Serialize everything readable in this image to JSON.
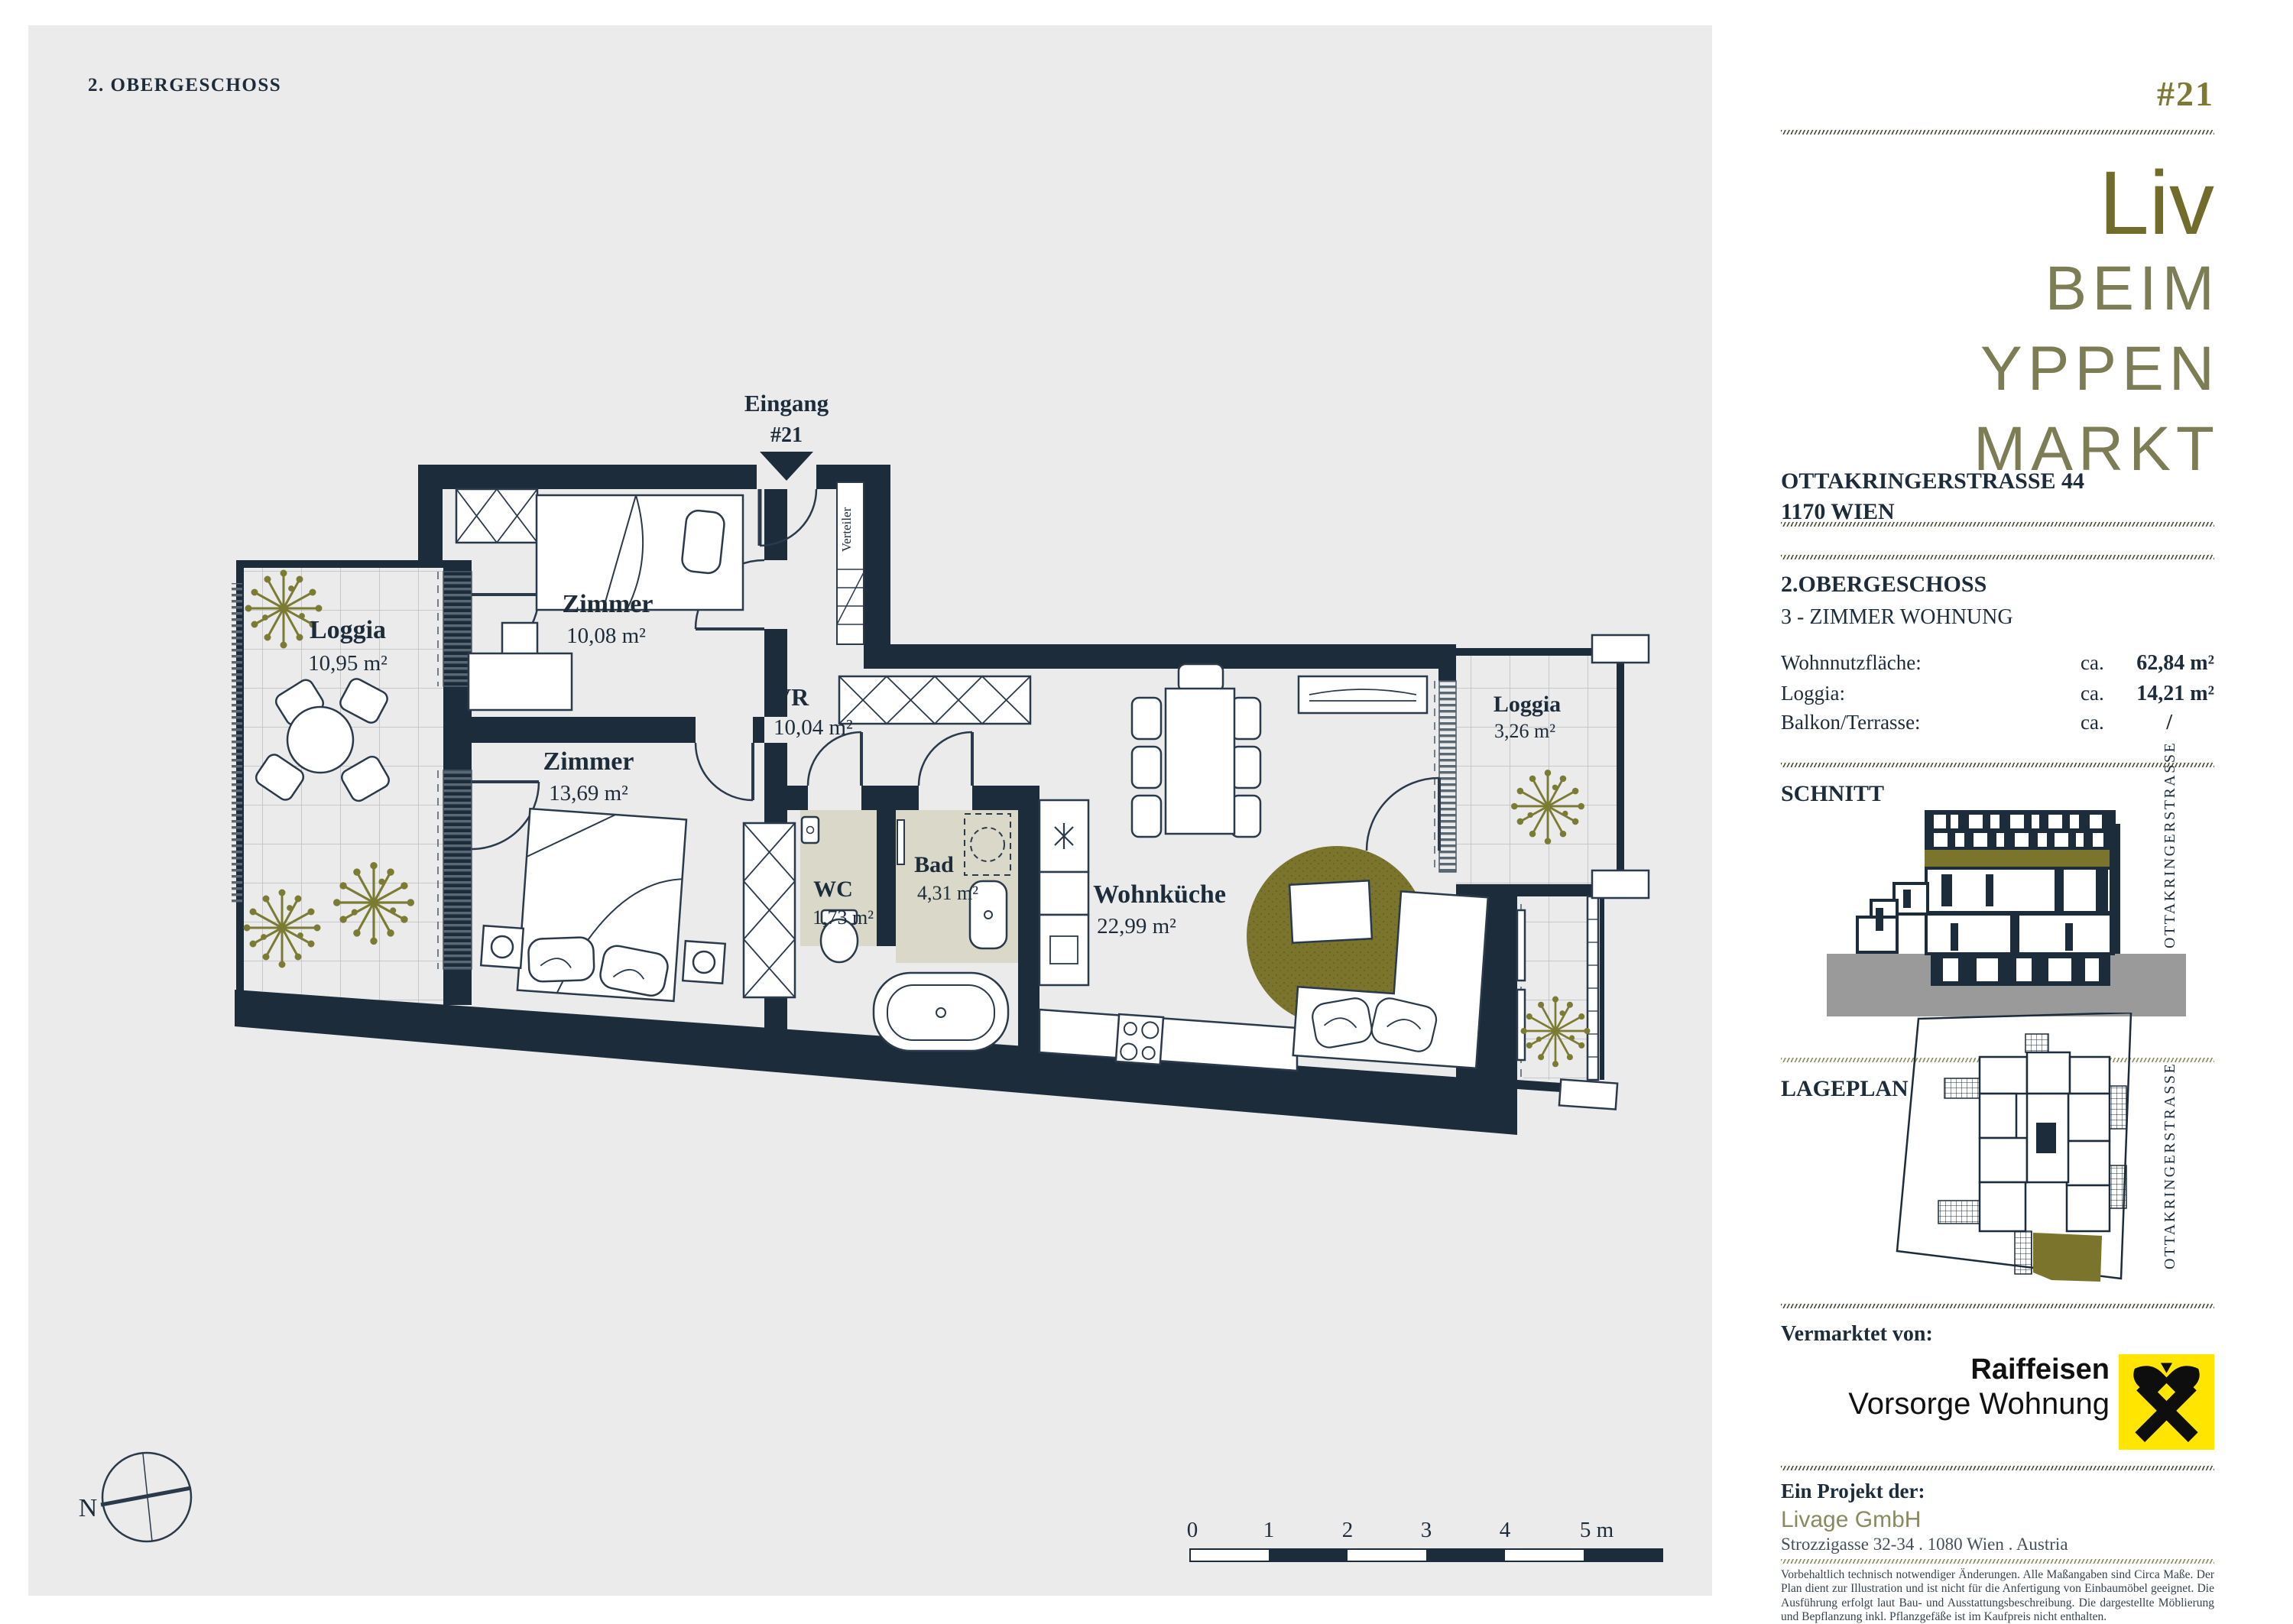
{
  "page": {
    "floor_label": "2. OBERGESCHOSS"
  },
  "plan": {
    "entrance": {
      "label": "Eingang",
      "unit": "#21"
    },
    "verteiler": "Verteiler",
    "compass": "N",
    "scale_labels": [
      "0",
      "1",
      "2",
      "3",
      "4",
      "5 m"
    ],
    "rooms": [
      {
        "name": "Loggia",
        "area": "10,95 m²"
      },
      {
        "name": "Zimmer",
        "area": "10,08 m²"
      },
      {
        "name": "Zimmer",
        "area": "13,69 m²"
      },
      {
        "name": "VR",
        "area": "10,04 m²"
      },
      {
        "name": "WC",
        "area": "1,73 m²"
      },
      {
        "name": "Bad",
        "area": "4,31 m²"
      },
      {
        "name": "Wohnküche",
        "area": "22,99 m²"
      },
      {
        "name": "Loggia",
        "area": "3,26 m²"
      }
    ]
  },
  "sidebar": {
    "unit_number": "#21",
    "logo_lines": [
      "Liv",
      "BEIM",
      "YPPEN",
      "MARKT"
    ],
    "address_line1": "OTTAKRINGERSTRASSE 44",
    "address_line2": "1170 WIEN",
    "floor_title": "2.OBERGESCHOSS",
    "floor_subtitle": "3 - ZIMMER WOHNUNG",
    "metrics": [
      {
        "label": "Wohnnutzfläche:",
        "approx": "ca.",
        "value": "62,84 m²"
      },
      {
        "label": "Loggia:",
        "approx": "ca.",
        "value": "14,21 m²"
      },
      {
        "label": "Balkon/Terrasse:",
        "approx": "ca.",
        "value": "/"
      }
    ],
    "schnitt_title": "SCHNITT",
    "lageplan_title": "LAGEPLAN",
    "street_vertical": "OTTAKRINGERSTRASSE",
    "marketed_by_label": "Vermarktet von:",
    "raiffeisen_line1": "Raiffeisen",
    "raiffeisen_line2": "Vorsorge Wohnung",
    "project_label": "Ein Projekt der:",
    "project_company": "Livage GmbH",
    "project_address": "Strozzigasse 32-34 . 1080 Wien . Austria",
    "disclaimer": "Vorbehaltlich technisch notwendiger Änderungen. Alle Maßangaben sind Circa Maße. Der Plan dient zur Illustration und ist nicht für die Anfertigung von Einbaumöbel geeignet. Die Ausführung erfolgt laut Bau- und Ausstattungsbeschreibung. Die dargestellte Möblierung und Bepflanzung inkl. Pflanzgefäße ist im Kaufpreis nicht enthalten."
  },
  "colors": {
    "wall_navy": "#1d2c3b",
    "accent_olive": "#7b742d",
    "plan_bg": "#ebebec",
    "wet_room_floor": "#d9d8c9",
    "raiffeisen_yellow": "#ffe500",
    "ground_gray": "#9a9a9a"
  }
}
